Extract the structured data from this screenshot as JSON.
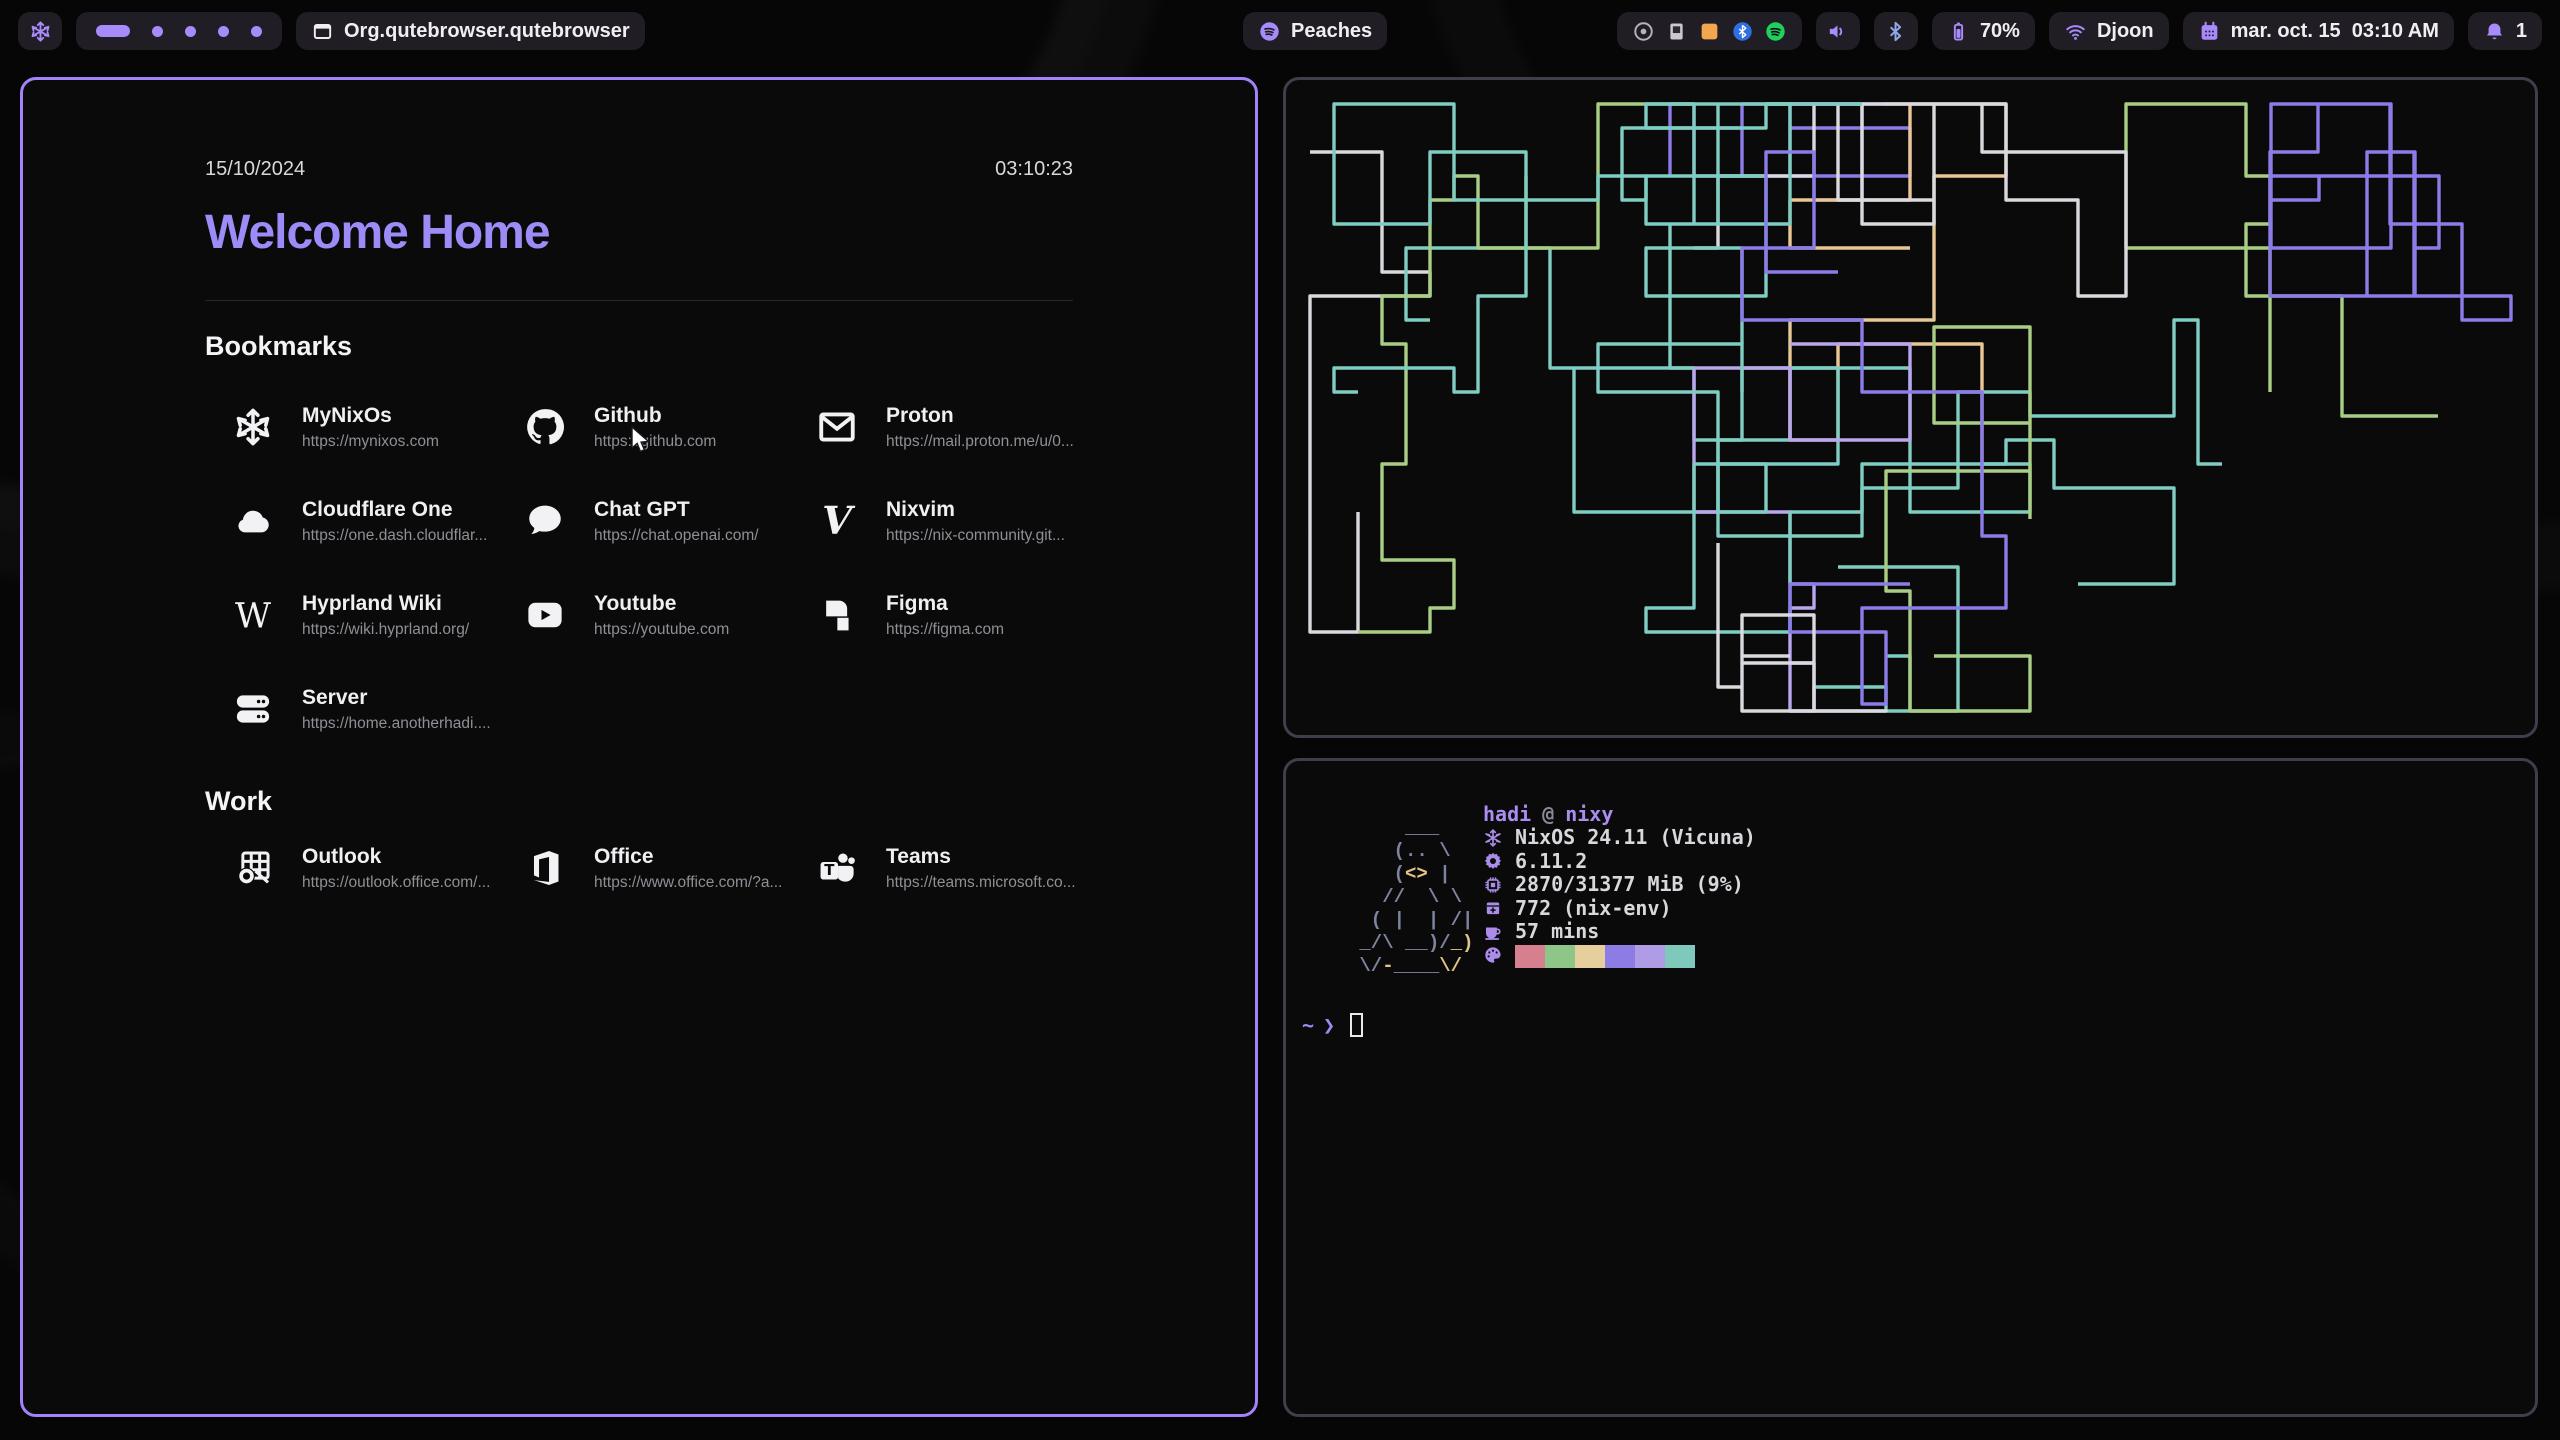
{
  "topbar": {
    "accent": "#a78bfa",
    "logo": "nix-logo",
    "workspaces": {
      "count": 5,
      "active_index": 0
    },
    "window_title": "Org.qutebrowser.qutebrowser",
    "media": {
      "label": "Peaches"
    },
    "tray_icons": [
      "disc",
      "applet",
      "orange-app",
      "bluetooth-logo",
      "spotify-logo"
    ],
    "battery": {
      "percent": "70%"
    },
    "network": {
      "ssid": "Djoon"
    },
    "clock": {
      "text": "mar. oct. 15  03:10 AM"
    },
    "notifications": {
      "count": "1"
    }
  },
  "startpage": {
    "date": "15/10/2024",
    "time": "03:10:23",
    "title": "Welcome Home",
    "sections": [
      {
        "heading": "Bookmarks",
        "items": [
          {
            "name": "MyNixOs",
            "url": "https://mynixos.com",
            "icon": "nix"
          },
          {
            "name": "Github",
            "url": "https://github.com",
            "icon": "github"
          },
          {
            "name": "Proton",
            "url": "https://mail.proton.me/u/0...",
            "icon": "envelope"
          },
          {
            "name": "Cloudflare One",
            "url": "https://one.dash.cloudflar...",
            "icon": "cloud"
          },
          {
            "name": "Chat GPT",
            "url": "https://chat.openai.com/",
            "icon": "chat-bubble"
          },
          {
            "name": "Nixvim",
            "url": "https://nix-community.git...",
            "icon": "nixvim-v"
          },
          {
            "name": "Hyprland Wiki",
            "url": "https://wiki.hyprland.org/",
            "icon": "wiki-w"
          },
          {
            "name": "Youtube",
            "url": "https://youtube.com",
            "icon": "youtube"
          },
          {
            "name": "Figma",
            "url": "https://figma.com",
            "icon": "figma"
          },
          {
            "name": "Server",
            "url": "https://home.anotherhadi....",
            "icon": "server"
          }
        ]
      },
      {
        "heading": "Work",
        "items": [
          {
            "name": "Outlook",
            "url": "https://outlook.office.com/...",
            "icon": "outlook"
          },
          {
            "name": "Office",
            "url": "https://www.office.com/?a...",
            "icon": "office"
          },
          {
            "name": "Teams",
            "url": "https://teams.microsoft.co...",
            "icon": "teams"
          }
        ]
      }
    ]
  },
  "pipes": {
    "seed": 20241015,
    "count": 17,
    "colors": [
      "#7fcdc0",
      "#a9cd85",
      "#8b7ce8",
      "#d9d9de",
      "#7fcdc0",
      "#e6c795",
      "#8b7ce8",
      "#7fcdc0",
      "#a9cd85",
      "#b9a6ee",
      "#d9d9de",
      "#7fcdc0"
    ]
  },
  "terminal": {
    "user": "hadi",
    "at": "@",
    "host": "nixy",
    "rows": [
      {
        "icon": "snowflake",
        "text": "NixOS 24.11 (Vicuna)"
      },
      {
        "icon": "kernel",
        "text": "6.11.2"
      },
      {
        "icon": "memory",
        "text": "2870/31377 MiB (9%)"
      },
      {
        "icon": "packages",
        "text": "772 (nix-env)"
      },
      {
        "icon": "uptime",
        "text": "57 mins"
      }
    ],
    "palette": [
      "#d6808f",
      "#8ec687",
      "#e6cf9c",
      "#8d7ce4",
      "#af9ce4",
      "#7ec9bc"
    ],
    "art_colors": {
      "g": "#7e84a0",
      "y": "#e3c488"
    },
    "ascii_art": [
      [
        [
          "     ___",
          "g"
        ]
      ],
      [
        [
          "    (.. \\",
          "g"
        ]
      ],
      [
        [
          "    (",
          "g"
        ],
        [
          "<>",
          "y"
        ],
        [
          " |",
          "g"
        ]
      ],
      [
        [
          "   //  \\ \\",
          "g"
        ]
      ],
      [
        [
          "  ( |  | /|",
          "g"
        ]
      ],
      [
        [
          " _/\\ __)/",
          "g"
        ],
        [
          "_)",
          "y"
        ]
      ],
      [
        [
          " ",
          "g"
        ],
        [
          "\\/",
          "g"
        ],
        [
          "-",
          "y"
        ],
        [
          "____",
          "g"
        ],
        [
          "\\/",
          "y"
        ]
      ]
    ],
    "prompt": {
      "cwd": "~",
      "symbol": "❯"
    }
  }
}
